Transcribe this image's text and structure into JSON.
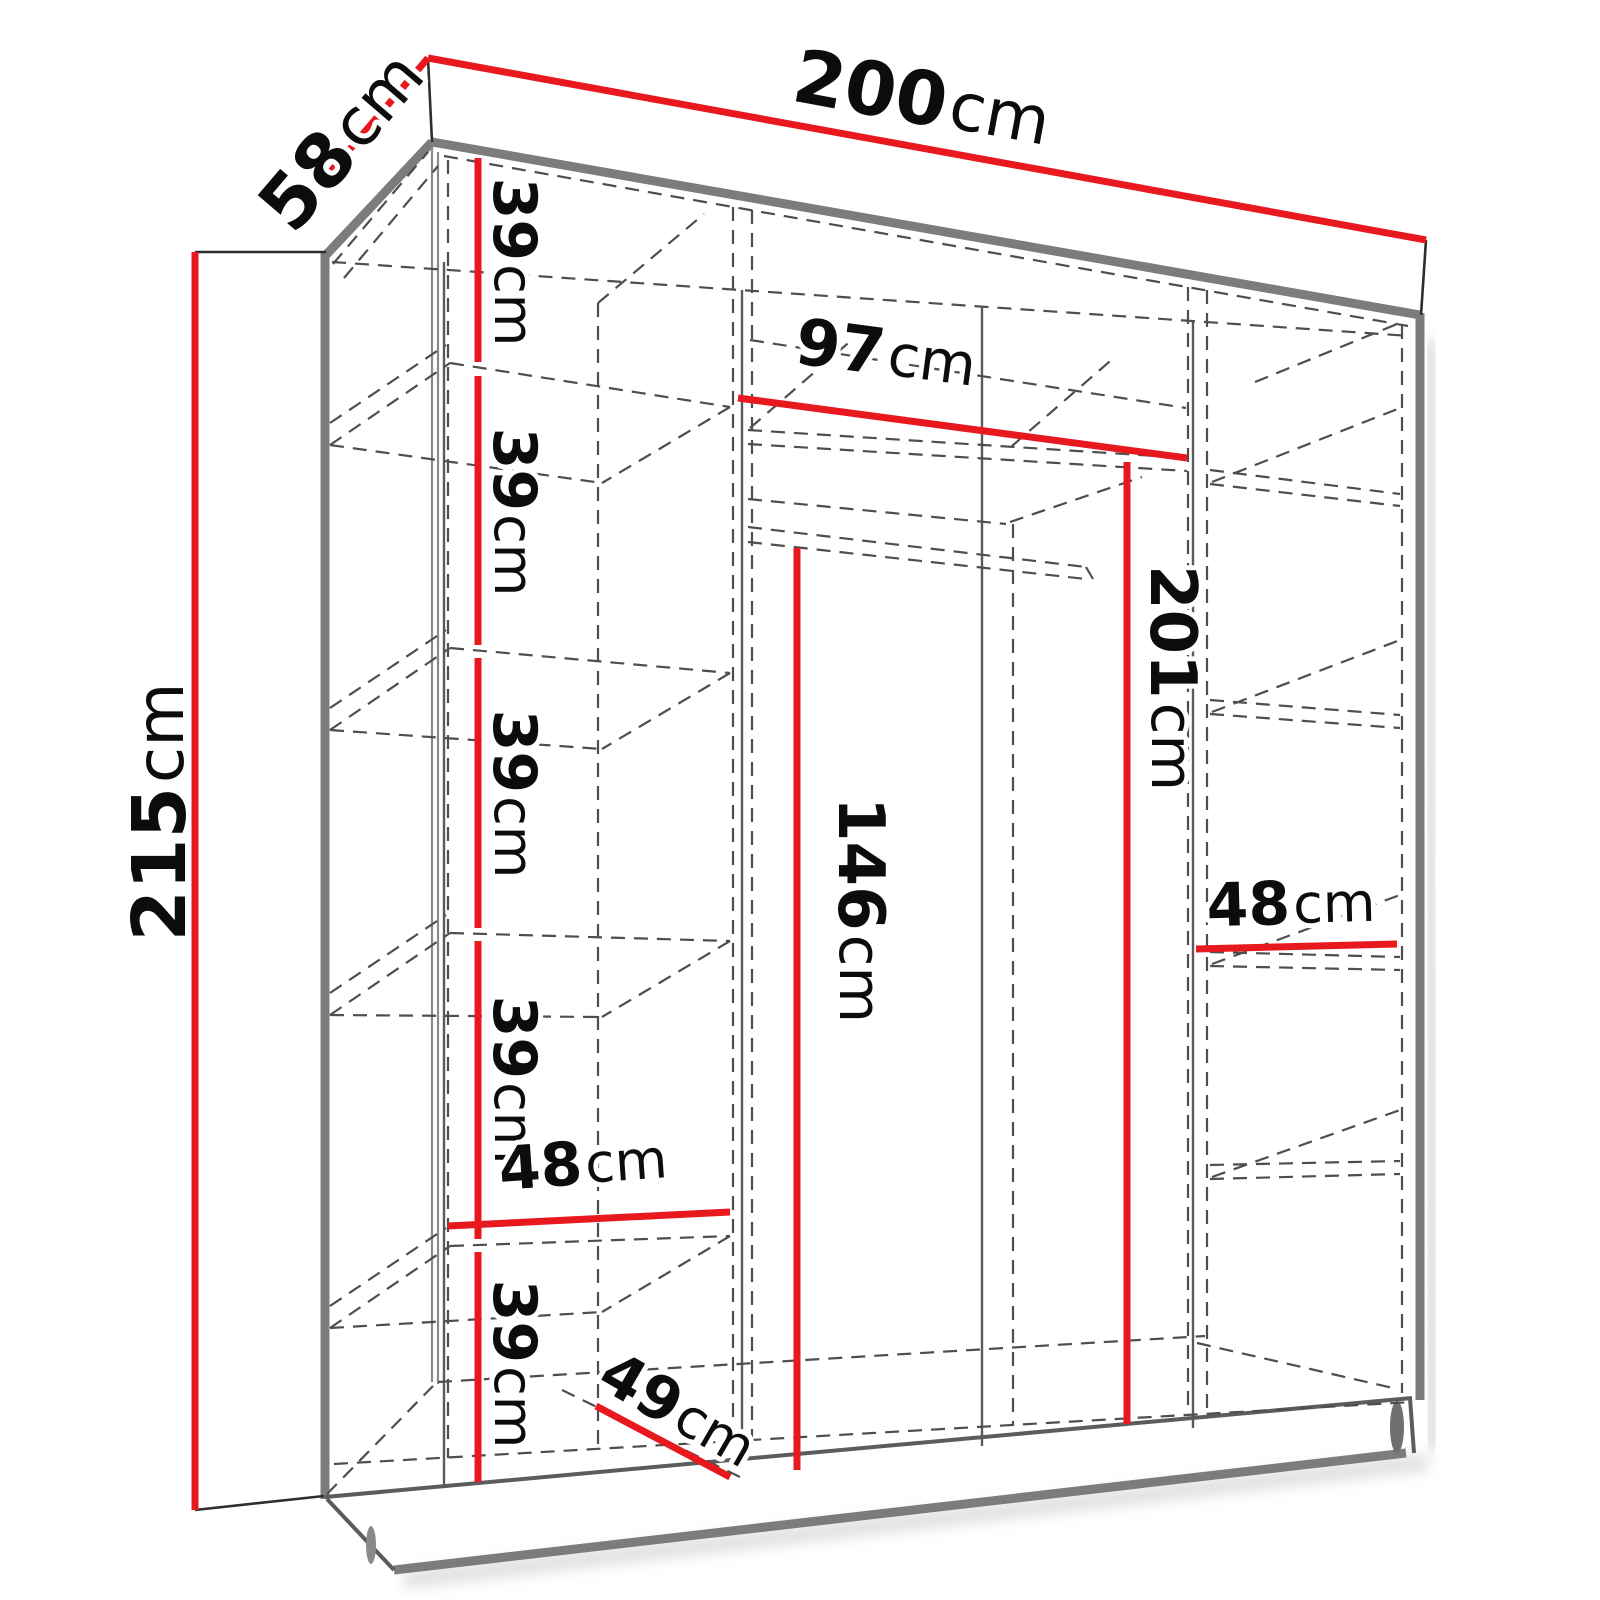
{
  "title": "Wardrobe dimension diagram",
  "unit": "cm",
  "colors": {
    "dimension_line": "#e8191e",
    "label_text": "#0c0c0c",
    "structure_gray": "#7c7c7c"
  },
  "dimensions": {
    "overall_width": {
      "value": "200",
      "unit": "cm"
    },
    "overall_depth": {
      "value": "58",
      "unit": "cm"
    },
    "overall_height": {
      "value": "215",
      "unit": "cm"
    },
    "hanging_section_width": {
      "value": "97",
      "unit": "cm"
    },
    "interior_height": {
      "value": "201",
      "unit": "cm"
    },
    "hanging_height": {
      "value": "146",
      "unit": "cm"
    },
    "left_shelf_width": {
      "value": "48",
      "unit": "cm"
    },
    "right_shelf_width": {
      "value": "48",
      "unit": "cm"
    },
    "bottom_shelf_depth": {
      "value": "49",
      "unit": "cm"
    },
    "shelf_spacings": [
      {
        "value": "39",
        "unit": "cm"
      },
      {
        "value": "39",
        "unit": "cm"
      },
      {
        "value": "39",
        "unit": "cm"
      },
      {
        "value": "39",
        "unit": "cm"
      },
      {
        "value": "39",
        "unit": "cm"
      }
    ]
  }
}
